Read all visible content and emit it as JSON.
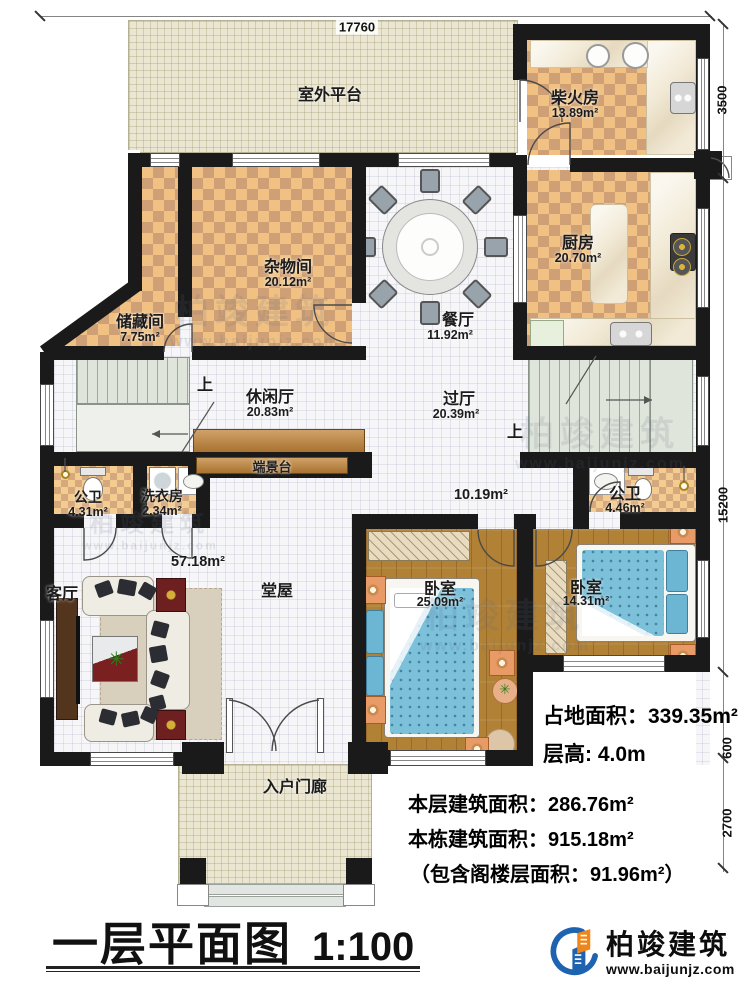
{
  "title": {
    "text": "一层平面图",
    "scale": "1:100"
  },
  "logo": {
    "brand": "柏竣建筑",
    "url": "www.baijunjz.com"
  },
  "watermark": {
    "brand": "柏竣建筑",
    "url": "www.baijunjz.com"
  },
  "dimensions": {
    "top": "17760",
    "right_top": "3500",
    "right_mid": "15200",
    "right_low": "600",
    "right_bottom": "2700"
  },
  "stats": {
    "land": "占地面积：339.35m²",
    "floor_height": "层高: 4.0m",
    "floor_area": "本层建筑面积：286.76m²",
    "building_area": "本栋建筑面积：915.18m²",
    "attic_note": "（包含阁楼层面积：91.96m²）"
  },
  "stairs": {
    "up": "上"
  },
  "rooms": {
    "platform": {
      "name": "室外平台"
    },
    "firewood": {
      "name": "柴火房",
      "area": "13.89m²"
    },
    "kitchen": {
      "name": "厨房",
      "area": "20.70m²"
    },
    "sundry": {
      "name": "杂物间",
      "area": "20.12m²"
    },
    "storage": {
      "name": "储藏间",
      "area": "7.75m²"
    },
    "dining": {
      "name": "餐厅",
      "area": "11.92m²"
    },
    "leisure": {
      "name": "休闲厅",
      "area": "20.83m²"
    },
    "hallway": {
      "name": "过厅",
      "area": "20.39m²"
    },
    "console": {
      "name": "端景台"
    },
    "bath1": {
      "name": "公卫",
      "area": "4.31m²"
    },
    "laundry": {
      "name": "洗衣房",
      "area": "2.34m²"
    },
    "bath2": {
      "name": "公卫",
      "area": "4.46m²"
    },
    "living": {
      "name": "客厅"
    },
    "hall": {
      "name": "堂屋",
      "area": "57.18m²",
      "corridor_area": "10.19m²"
    },
    "bedroom1": {
      "name": "卧室",
      "area": "25.09m²"
    },
    "bedroom2": {
      "name": "卧室",
      "area": "14.31m²"
    },
    "porch": {
      "name": "入户门廊"
    }
  }
}
